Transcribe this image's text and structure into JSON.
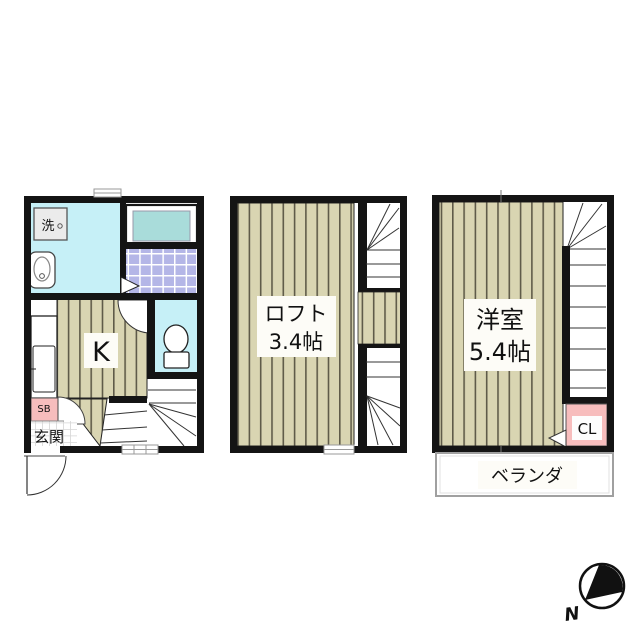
{
  "first_floor": {
    "washer_label": "洗",
    "kitchen_label": "K",
    "shoe_box_label": "SB",
    "entrance_label": "玄関"
  },
  "loft": {
    "name_label": "ロフト",
    "area_label": "3.4帖"
  },
  "second_floor": {
    "room_label": "洋室",
    "area_label": "5.4帖",
    "closet_label": "CL",
    "veranda_label": "ベランダ"
  },
  "compass": {
    "north_label": "N"
  },
  "colors": {
    "wall": "#141414",
    "water_area": "#c6f0f7",
    "bathtub_water": "#a9dcda",
    "bath_tile": "#b4b6e7",
    "wood_floor": "#d9d5b2",
    "wood_stripe": "#5f5b49",
    "pink_storage": "#f7bdbd",
    "label_bg": "#fdfcf7"
  }
}
